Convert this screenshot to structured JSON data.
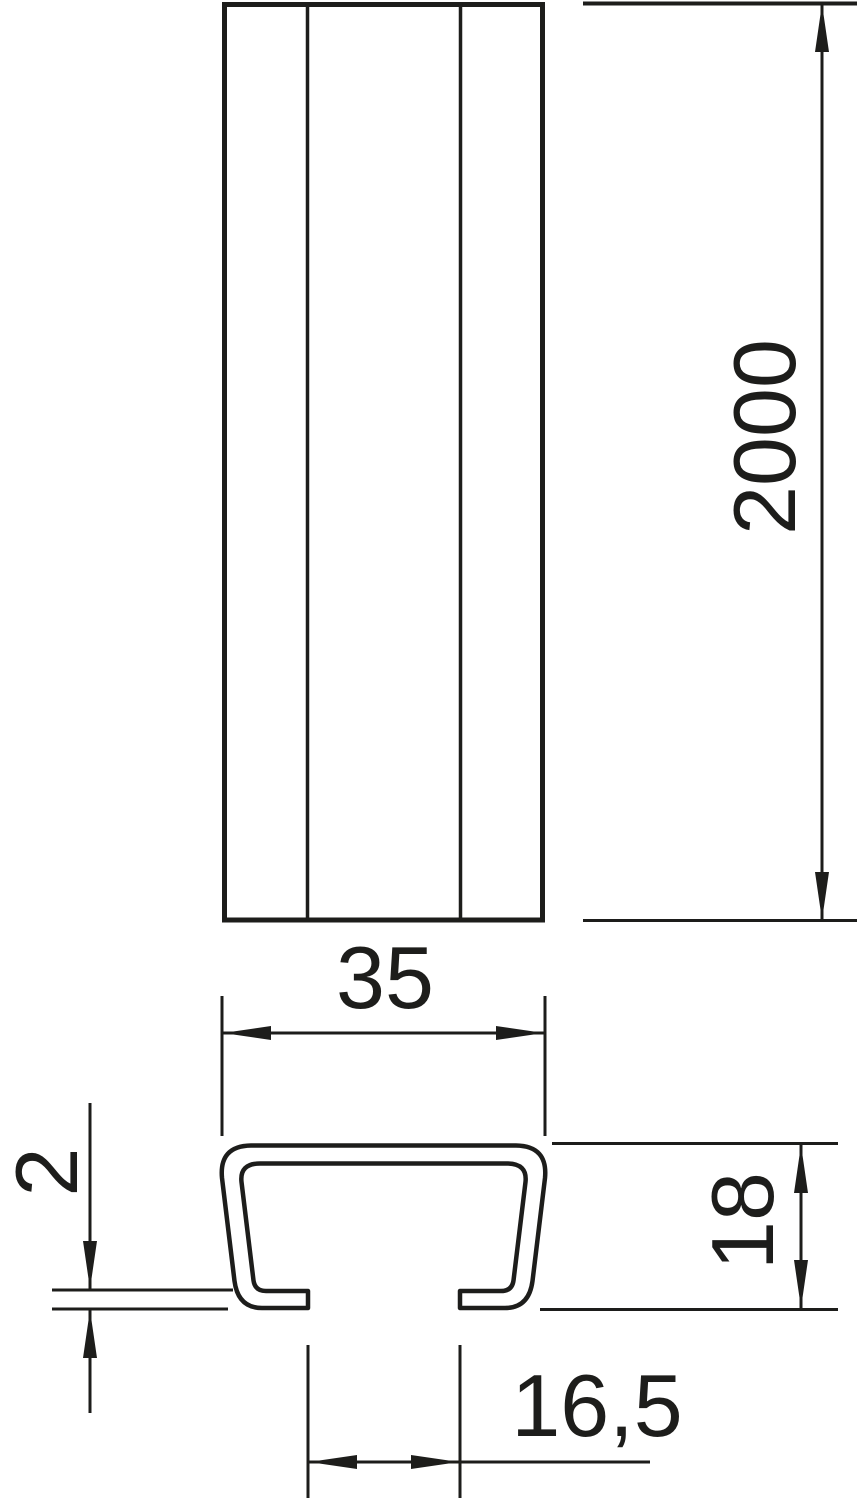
{
  "drawing": {
    "description": "Two-view technical dimension drawing of a C-profile mounting rail",
    "colors": {
      "line": "#1d1d1b",
      "background": "#ffffff"
    },
    "views": {
      "front": {
        "length_label": "2000"
      },
      "section": {
        "width_label": "35",
        "height_label": "18",
        "thickness_label": "2",
        "slot_label": "16,5"
      }
    }
  }
}
